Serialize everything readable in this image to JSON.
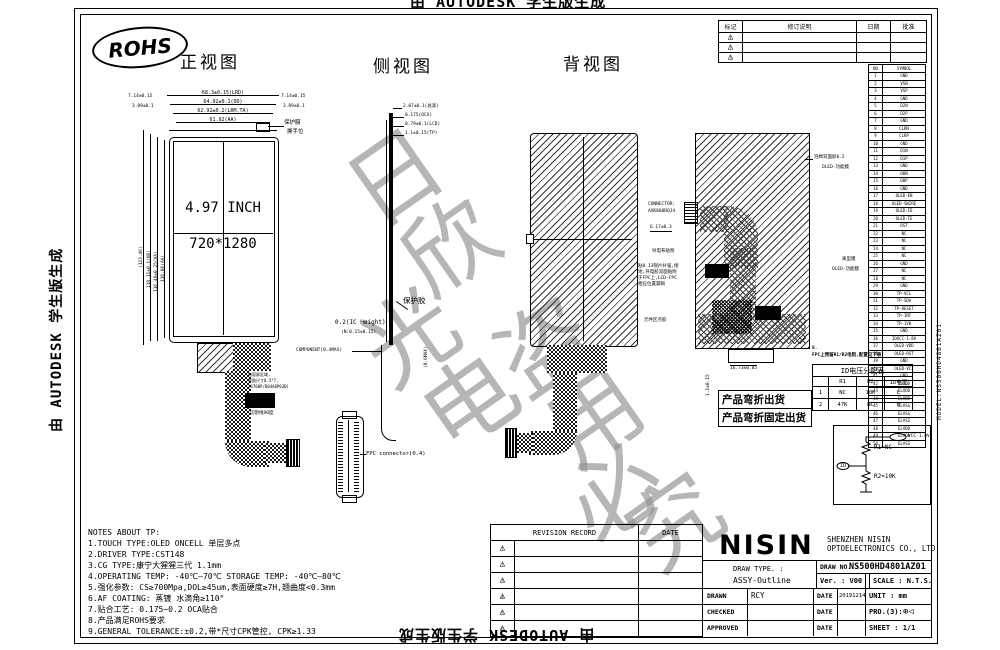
{
  "frame": {
    "autodesk_watermark": "由 AUTODESK 学生版生成",
    "gray_watermark_chars": [
      "日",
      "欣",
      "光",
      "电",
      "盗",
      "用",
      "必",
      "究"
    ],
    "right_edge_text": "MODEL:NS500HD4801AZ01",
    "rohs_label": "ROHS"
  },
  "views": {
    "front": {
      "title": "正视图",
      "panel_size": "4.97 INCH",
      "panel_res": "720*1280",
      "top_dims": [
        "68.3±0.15(LRD)",
        "64.92±0.1(OD)",
        "62.92±0.2(LRM.TA)",
        "61.92(AA)"
      ],
      "side_dim_a": "7.14±0.15",
      "side_dim_b": "3.89±0.1",
      "left_dims": [
        "(123.46)",
        "118.11±0.1(OD)",
        "116.48±0.25(VA)",
        "116.06(AA)"
      ],
      "film_label": "保护膜",
      "tear_label": "撕手位",
      "fpc_note": [
        "电容屏区域,",
        "背胶尺寸0.5*7,",
        "(6700P/D04A0P03B)"
      ],
      "cut_note": "切割线90度"
    },
    "side": {
      "title": "侧视图",
      "stack_dims": [
        "2.07±0.1(总高)",
        "0.175(OCA)",
        "0.79±0.1(LCD)",
        "1.1±0.15(TP)"
      ],
      "glue_label": "保护胶",
      "ic_height": "0.2(IC Height)",
      "ic_tol": "(N:0.15±0.15)",
      "component_label": "COMPONENT(0.4MAX)",
      "max_label": "(0.6MAX)",
      "connector_label": "FPC connector(0.4)"
    },
    "back": {
      "title": "背视图",
      "connector_line1": "CONNECTOR:",
      "connector_line2": "AXK860RQJ4",
      "connector_dim": "6.17±0.3",
      "foam_label": "导电布贴附",
      "copper_note": [
        "贴0.13铜片补强,接",
        "地,导电胶双面贴附",
        "于FPC上,LCD-FPC",
        "相应位置漏铜"
      ],
      "glue_label": "元件区点胶",
      "film_label_1": "泡棉双面胶0.2",
      "film_label_2": "OLED-功能膜",
      "release_label_1": "离型膜",
      "release_label_2": "OLED-功能膜",
      "bottom_dim": "16.73±0.05",
      "bottom_dim_2": "1.1±0.15"
    }
  },
  "rev_table": {
    "headers": [
      "标记",
      "修订说明",
      "日期",
      "批准"
    ]
  },
  "pin_table": {
    "headers": [
      "NO",
      "SYMBOL"
    ],
    "pins": [
      "GND",
      "VSN",
      "VSP",
      "GND",
      "D2N",
      "D2P",
      "GND",
      "CLKN",
      "CLKP",
      "GND",
      "D1N",
      "D1P",
      "GND",
      "D0N",
      "D0P",
      "GND",
      "OLED-EN",
      "OLED-SWIRE",
      "OLED-ID",
      "OLED-TE",
      "RST",
      "NC",
      "NC",
      "NC",
      "NC",
      "GND",
      "NC",
      "NC",
      "GND",
      "TP-VCL",
      "TP-SDA",
      "TP-RESET",
      "TP-INT",
      "TP-1V8",
      "GND",
      "IOVCC-1.8V",
      "OLED-VDD",
      "OLED-RST",
      "GND",
      "OLED-VCI",
      "GND",
      "ELVDD",
      "ELVDD",
      "ELVDD",
      "ELVSS",
      "ELVSS",
      "ELVSS",
      "ELVDD",
      "ELVDD",
      "ELVSS"
    ]
  },
  "id_note": [
    "8.",
    "FPC上预留R1/R2电阻,配置见下表"
  ],
  "id_table": {
    "title": "ID电压分配表",
    "headers": [
      "",
      "R1",
      "R2",
      "ID电压"
    ],
    "rows": [
      [
        "1",
        "NC",
        "10K",
        "L"
      ],
      [
        "2",
        "47K",
        "NC",
        "H"
      ]
    ]
  },
  "ship_box": [
    "产品弯折出货",
    "产品弯折固定出货"
  ],
  "schematic": {
    "vcc": "VCC-1.8V",
    "r1": "R1=NC",
    "r2": "R2=10K",
    "id": "ID"
  },
  "notes": {
    "title": "NOTES ABOUT TP:",
    "lines": [
      "1.TOUCH TYPE:OLED ONCELL 单层多点",
      "2.DRIVER TYPE:CST148",
      "3.CG TYPE:康宁大猩猩三代  1.1mm",
      "4.OPERATING TEMP: -40℃—70℃ STORAGE TEMP: -40℃—80℃",
      "5.强化参数: CS≥700Mpa,DOL≥45um,表面硬度≥7H,翘曲度<0.3mm",
      "6.AF COATING: 蒸镀 水滴角≥110°",
      "7.贴合工艺:  0.175~0.2 OCA贴合",
      "8.产品满足ROHS要求",
      "9.GENERAL TOLERANCE:±0.2,带*尺寸CPK管控, CPK≥1.33"
    ]
  },
  "revision_record": {
    "title": "REVISION RECORD",
    "date_header": "DATE"
  },
  "title_block": {
    "logo": "NISIN",
    "company_1": "SHENZHEN NISIN",
    "company_2": "OPTOELECTRONICS CO., LTD",
    "draw_type_label": "DRAW TYPE. :",
    "draw_type": "ASSY-Outline",
    "draw_no_label": "DRAW NO. :",
    "draw_no": "NS500HD4801AZ01",
    "ver_label": "Ver. :  V00",
    "scale_label": "SCALE : N.T.S.",
    "drawn_label": "DRAWN",
    "drawn": "RCY",
    "checked_label": "CHECKED",
    "approved_label": "APPROVED",
    "date_label": "DATE",
    "drawn_date": "20191214",
    "unit_label": "UNIT : mm",
    "pro_label": "PRO.(3):",
    "pro_symbol": "⊕◁",
    "sheet_label": "SHEET :  1/1"
  }
}
